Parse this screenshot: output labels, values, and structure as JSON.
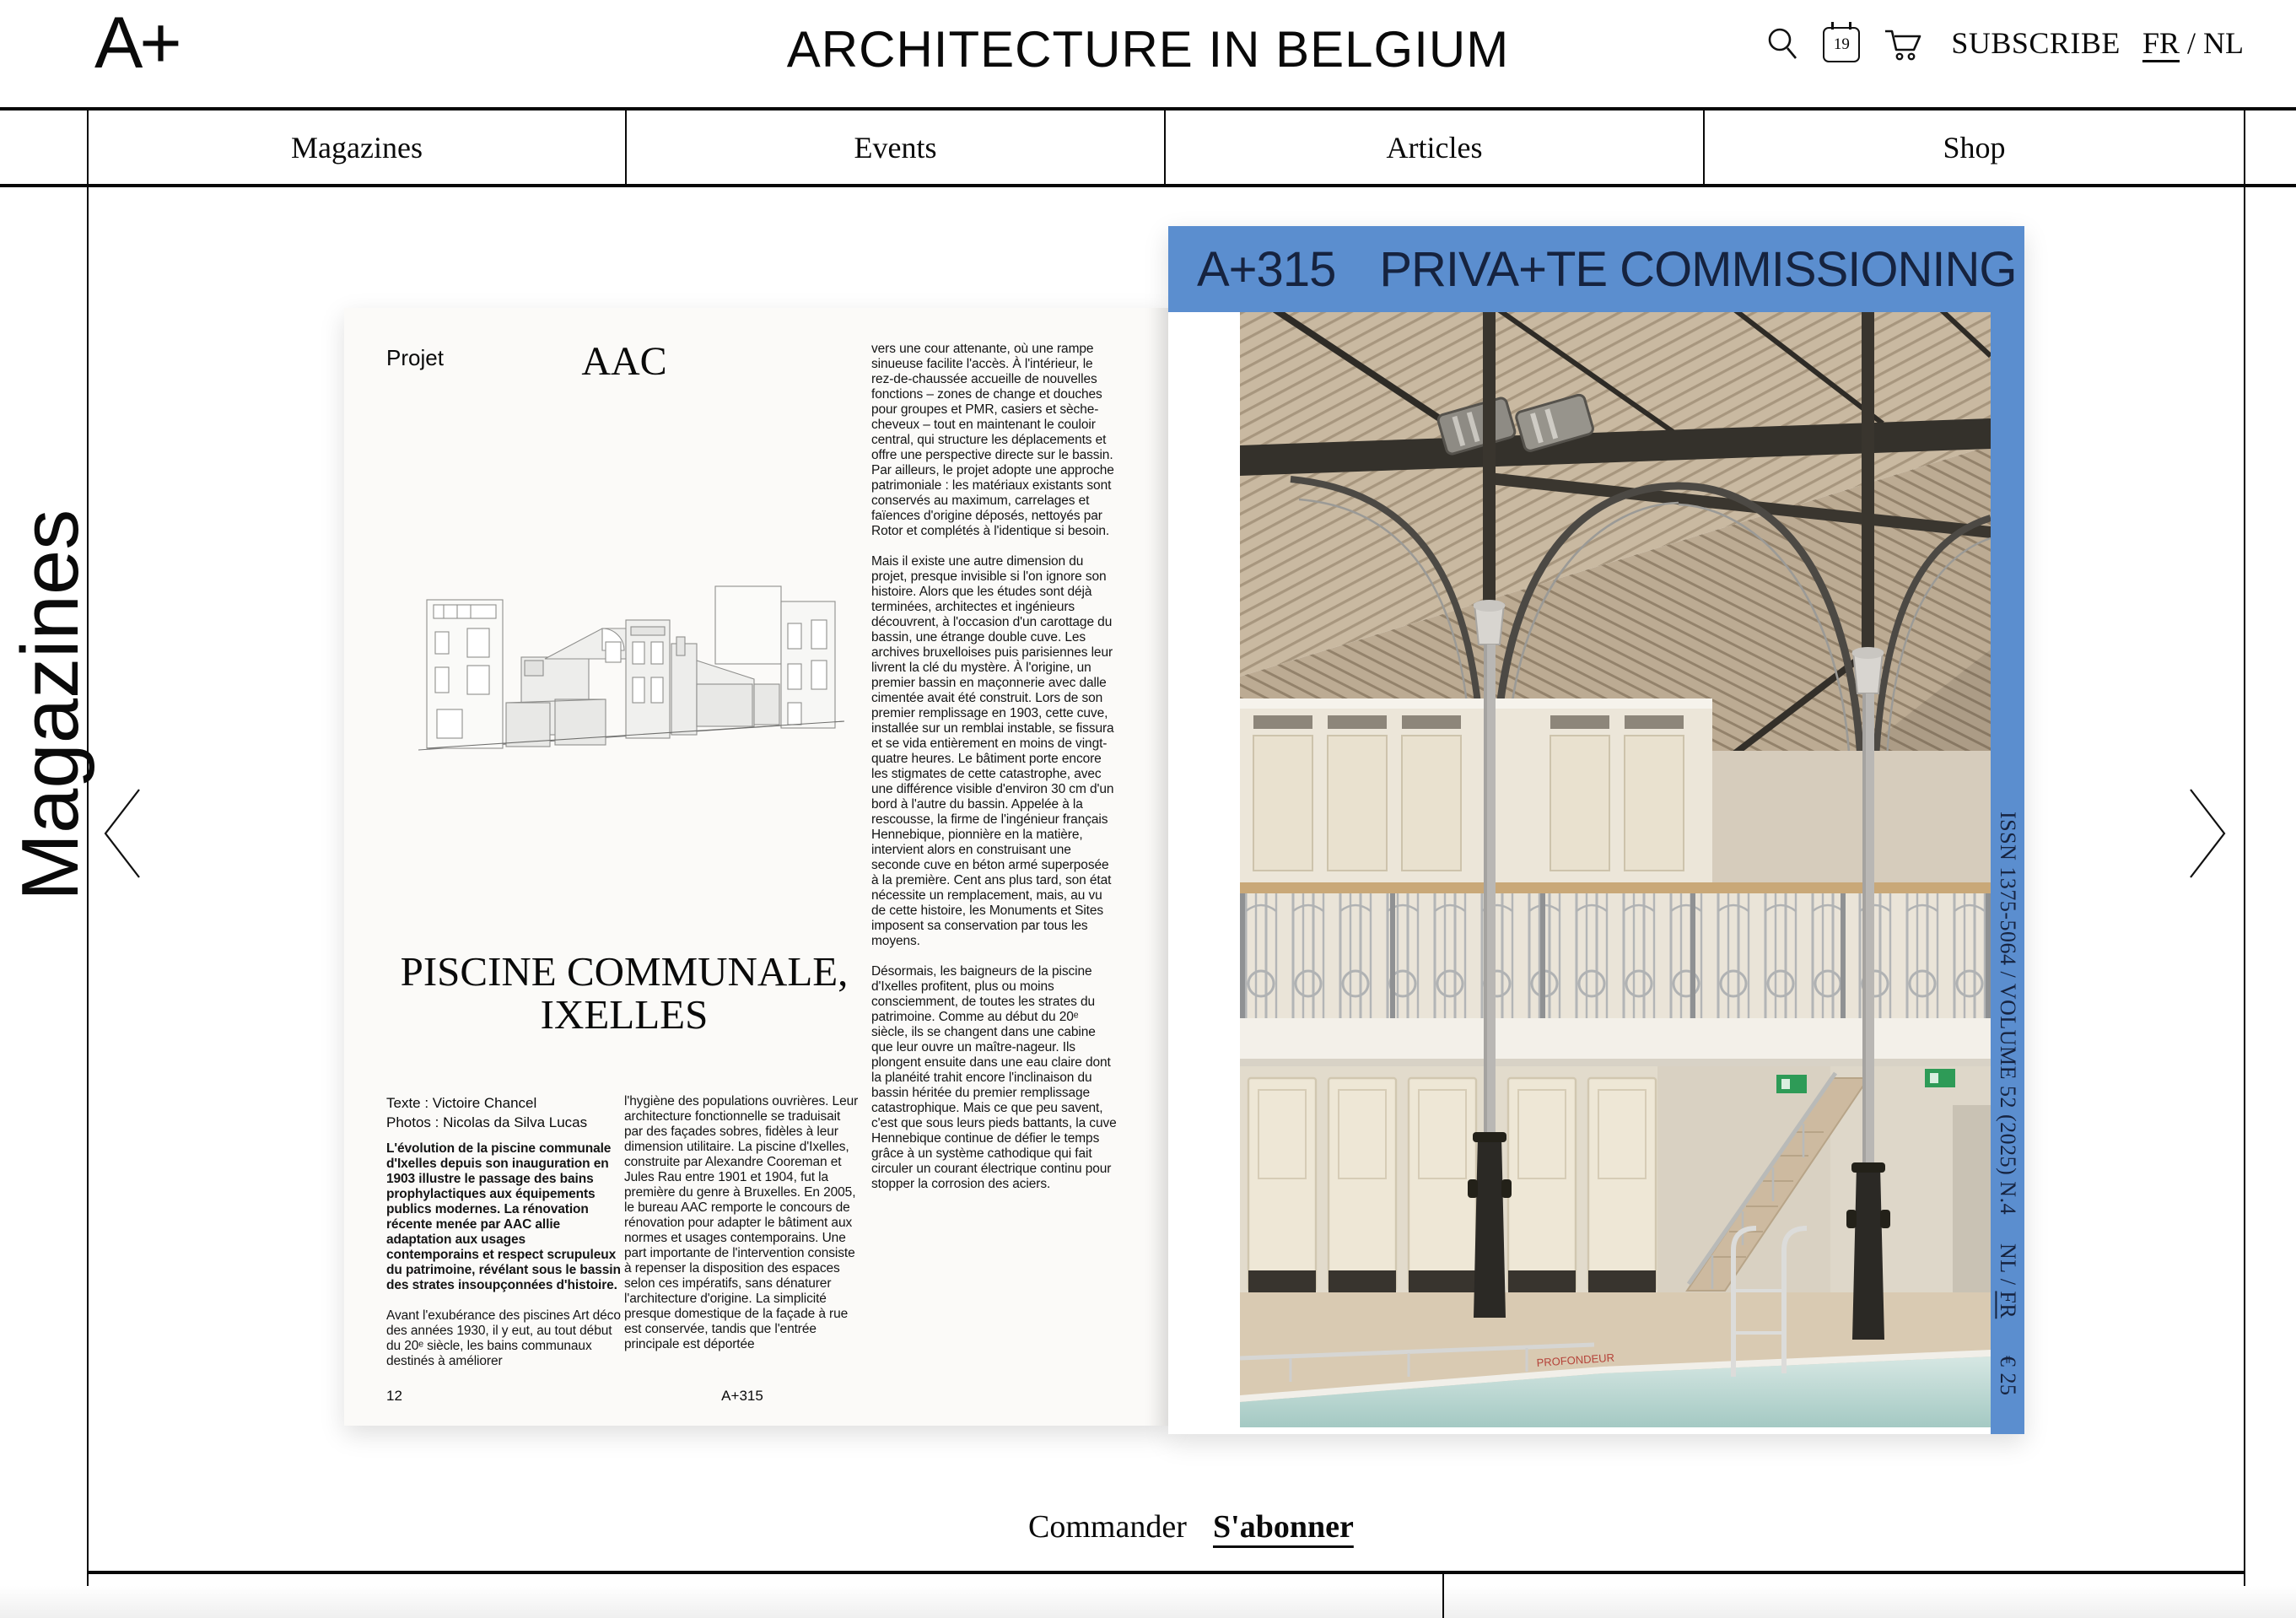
{
  "header": {
    "logo": "A+",
    "title": "ARCHITECTURE IN BELGIUM",
    "calendar_day": "19",
    "subscribe_label": "SUBSCRIBE",
    "lang_fr": "FR",
    "lang_sep": "/",
    "lang_nl": "NL"
  },
  "nav": {
    "items": [
      "Magazines",
      "Events",
      "Articles",
      "Shop"
    ]
  },
  "sidebar": {
    "section_label": "Magazines"
  },
  "spread": {
    "left_page": {
      "kicker": "Projet",
      "studio": "AAC",
      "title_line1": "PISCINE COMMUNALE,",
      "title_line2": "IXELLES",
      "credit_text": "Texte : Victoire Chancel",
      "credit_photos": "Photos : Nicolas da Silva Lucas",
      "intro_bold": "L'évolution de la piscine communale d'Ixelles depuis son inauguration en 1903 illustre le passage des bains prophylactiques aux équipements publics modernes. La rénovation récente menée par AAC allie adaptation aux usages contemporains et respect scrupuleux du patrimoine, révélant sous le bassin des strates insoupçonnées d'histoire.",
      "col1_para": "Avant l'exubérance des piscines Art déco des années 1930, il y eut, au tout début du 20ᵉ siècle, les bains communaux destinés à améliorer",
      "col2_para": "l'hygiène des populations ouvrières. Leur architecture fonctionnelle se traduisait par des façades sobres, fidèles à leur dimension utilitaire. La piscine d'Ixelles, construite par Alexandre Cooreman et Jules Rau entre 1901 et 1904, fut la première du genre à Bruxelles. En 2005, le bureau AAC remporte le concours de rénovation pour adapter le bâtiment aux normes et usages contemporains. Une part importante de l'intervention consiste à repenser la disposition des espaces selon ces impératifs, sans dénaturer l'architecture d'origine. La simplicité presque domestique de la façade à rue est conservée, tandis que l'entrée principale est déportée",
      "col3_para1": "vers une cour attenante, où une rampe sinueuse facilite l'accès. À l'intérieur, le rez-de-chaussée accueille de nouvelles fonctions – zones de change et douches pour groupes et PMR, casiers et sèche-cheveux – tout en maintenant le couloir central, qui structure les déplacements et offre une perspective directe sur le bassin. Par ailleurs, le projet adopte une approche patrimoniale : les matériaux existants sont conservés au maximum, carrelages et faïences d'origine déposés, nettoyés par Rotor et complétés à l'identique si besoin.",
      "col3_para2": "Mais il existe une autre dimension du projet, presque invisible si l'on ignore son histoire. Alors que les études sont déjà terminées, architectes et ingénieurs découvrent, à l'occasion d'un carottage du bassin, une étrange double cuve. Les archives bruxelloises puis parisiennes leur livrent la clé du mystère. À l'origine, un premier bassin en maçonnerie avec dalle cimentée avait été construit. Lors de son premier remplissage en 1903, cette cuve, installée sur un remblai instable, se fissura et se vida entièrement en moins de vingt-quatre heures. Le bâtiment porte encore les stigmates de cette catastrophe, avec une différence visible d'environ 30 cm d'un bord à l'autre du bassin. Appelée à la rescousse, la firme de l'ingénieur français Hennebique, pionnière en la matière, intervient alors en construisant une seconde cuve en béton armé superposée à la première. Cent ans plus tard, son état nécessite un remplacement, mais, au vu de cette histoire, les Monuments et Sites imposent sa conservation par tous les moyens.",
      "col3_para3": "Désormais, les baigneurs de la piscine d'Ixelles profitent, plus ou moins consciemment, de toutes les strates du patrimoine. Comme au début du 20ᵉ siècle, ils se changent dans une cabine que leur ouvre un maître-nageur. Ils plongent ensuite dans une eau claire dont la planéité trahit encore l'inclinaison du bassin héritée du premier remplissage catastrophique. Mais ce que peu savent, c'est que sous leurs pieds battants, la cuve Hennebique continue de défier le temps grâce à un système cathodique qui fait circuler un courant électrique continu pour stopper la corrosion des aciers.",
      "page_number": "12",
      "issue_footer": "A+315"
    },
    "cover": {
      "banner_issue": "A+315",
      "banner_title": "PRIVA+TE COMMISSIONING",
      "spine_issn": "ISSN 1375-5064 / VOLUME 52 (2025) N.4",
      "spine_lang_nl": "NL /",
      "spine_lang_fr": "FR",
      "spine_price": "€ 25",
      "pool_depth_label": "PROFONDEUR",
      "colors": {
        "banner_blue": "#5b8ecf",
        "banner_text": "#16233f"
      }
    }
  },
  "actions": {
    "order": "Commander",
    "subscribe": "S'abonner"
  }
}
